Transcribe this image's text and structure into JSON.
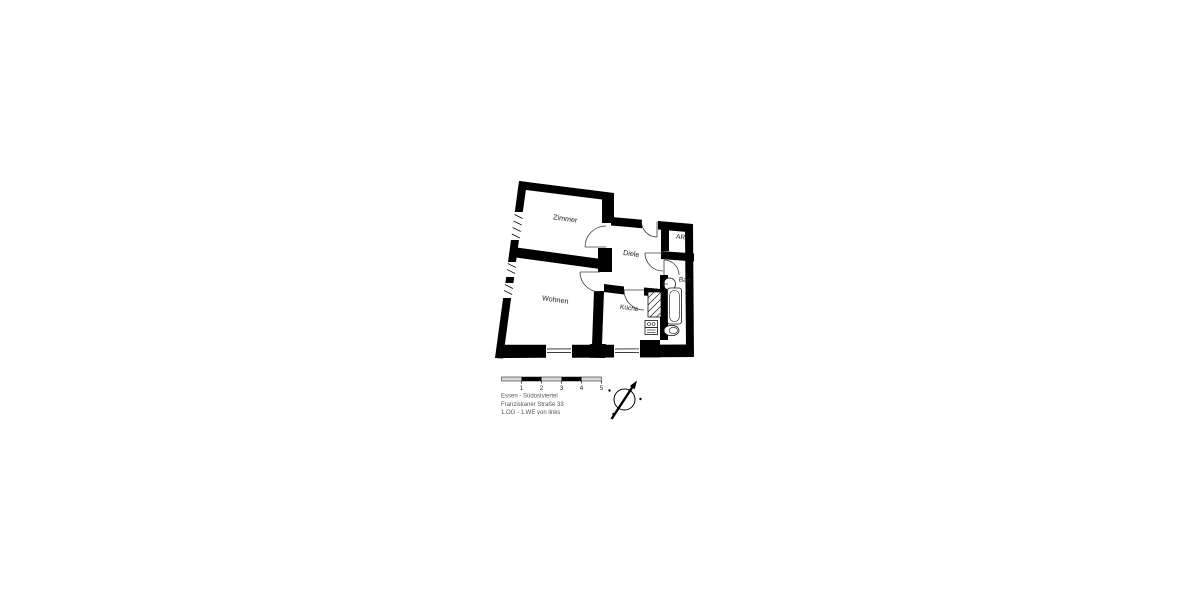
{
  "rooms": {
    "zimmer": "Zimmer",
    "wohnen": "Wohnen",
    "diele": "Diele",
    "kueche": "Küche",
    "bad": "Bad",
    "ar": "AR"
  },
  "scale_bar": {
    "labels": [
      "1",
      "2",
      "3",
      "4",
      "5"
    ]
  },
  "address": {
    "line1": "Essen - Südostviertel",
    "line2": "Franziskaner Straße 33",
    "line3": "1.OG - 1.WE von links"
  },
  "colors": {
    "wall": "#000000",
    "door_arc": "#3a3a3a",
    "footer_text": "#555555",
    "scale_fill": "#d9d9d9"
  }
}
